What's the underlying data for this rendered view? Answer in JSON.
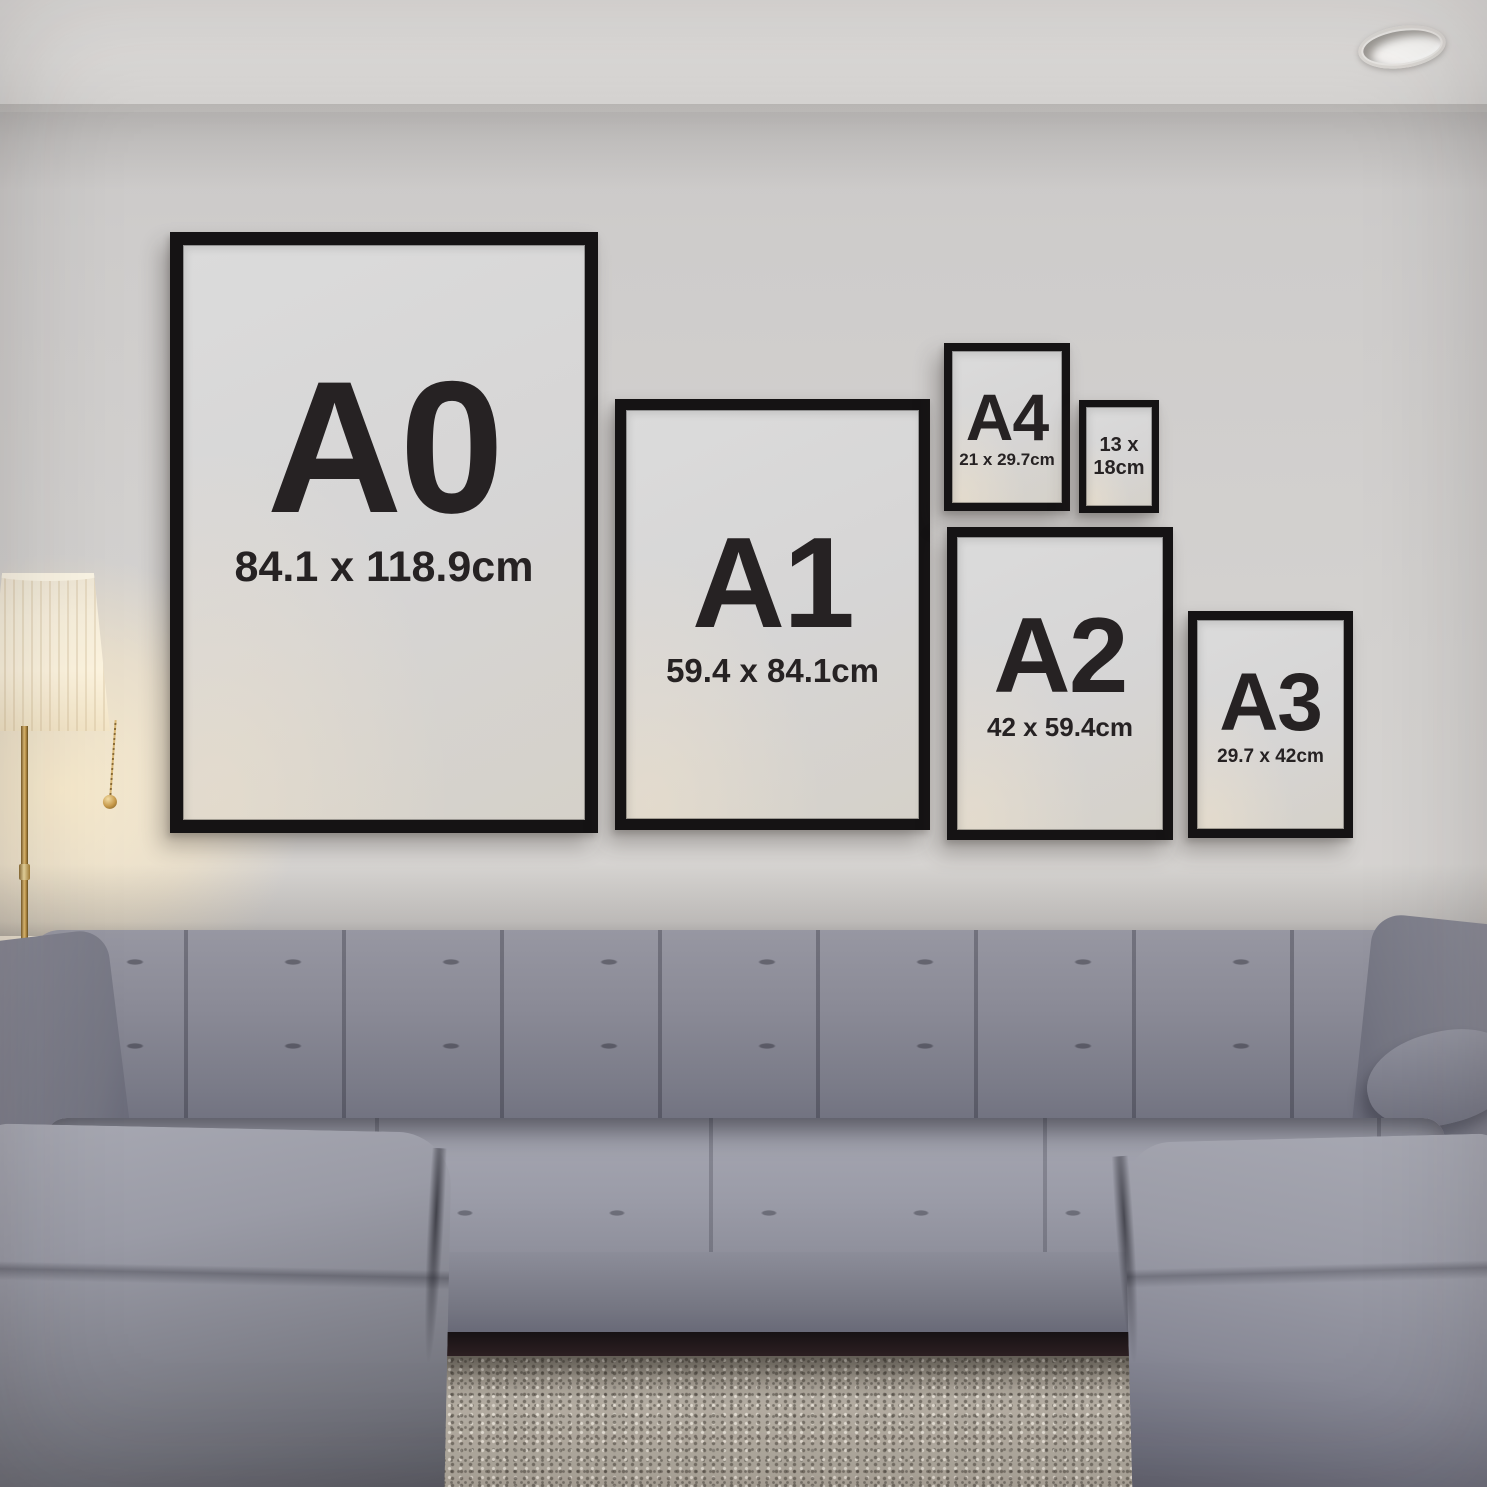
{
  "frames": {
    "a0": {
      "label": "A0",
      "dims": "84.1 x 118.9cm"
    },
    "a1": {
      "label": "A1",
      "dims": "59.4 x 84.1cm"
    },
    "a4": {
      "label": "A4",
      "dims": "21 x 29.7cm"
    },
    "size13x18": {
      "line1": "13 x",
      "line2": "18cm"
    },
    "a2": {
      "label": "A2",
      "dims": "42 x 59.4cm"
    },
    "a3": {
      "label": "A3",
      "dims": "29.7 x 42cm"
    }
  },
  "colors": {
    "frame_black": "#151314",
    "mat_gray": "#d6d5d4",
    "label_text": "#262223",
    "wall": "#d4d2d0",
    "ceiling": "#dedcda",
    "sofa_gray": "#7d7e8a",
    "rug_beige": "#b2aba0",
    "lamp_glow": "#f6e8cc",
    "lamp_brass": "#c09449"
  }
}
